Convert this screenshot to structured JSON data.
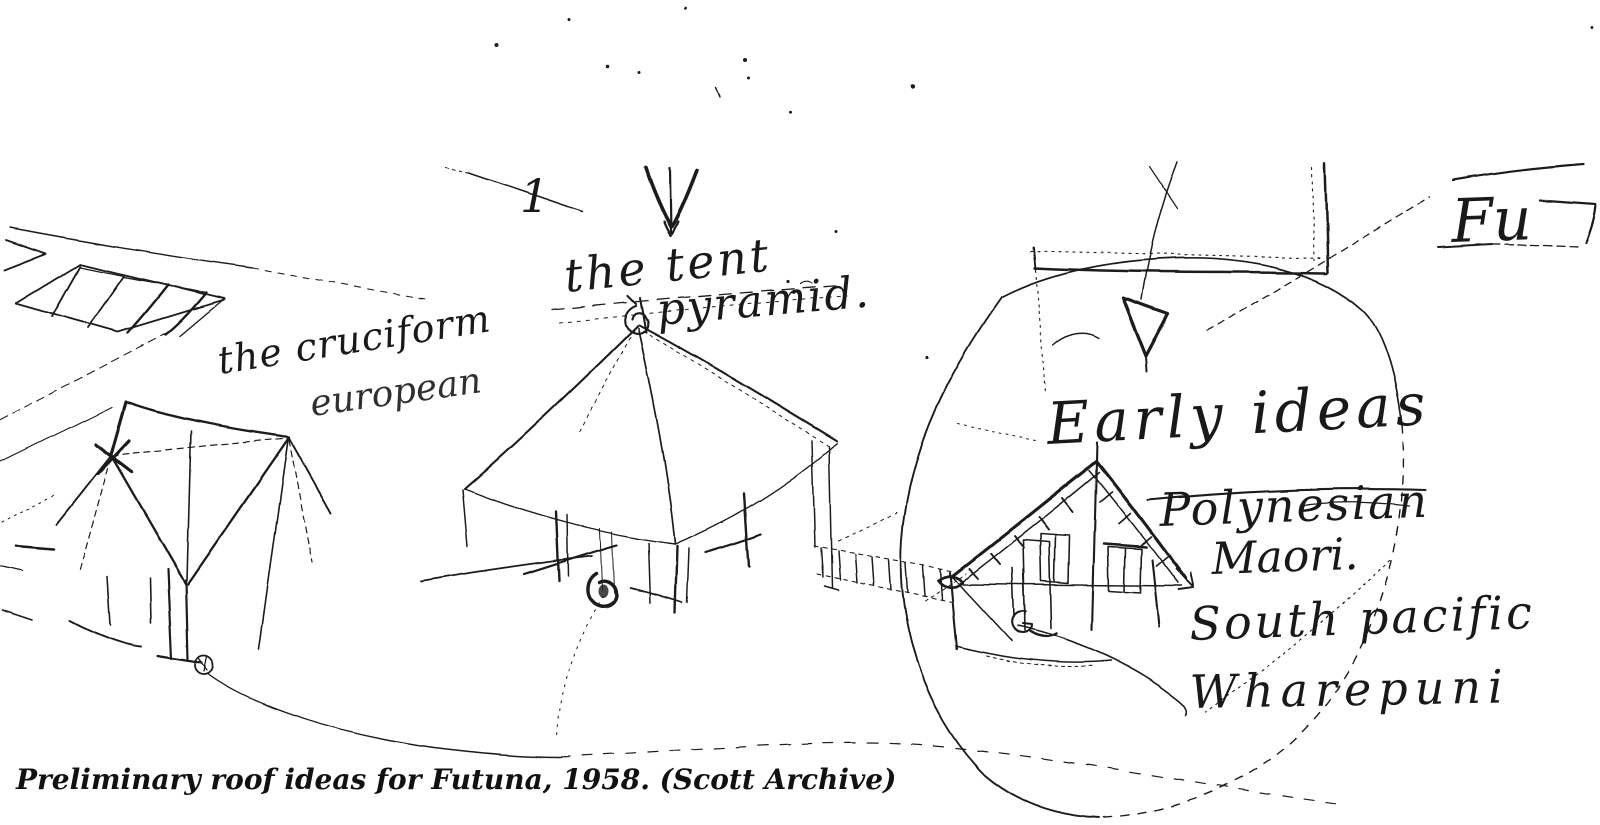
{
  "page": {
    "paper_color": "#ffffff",
    "ink_color": "#1d1d1d",
    "caption": "Preliminary roof ideas for Futuna, 1958. (Scott Archive)"
  },
  "annotations": {
    "marker": "1",
    "tent_line1": "the tent",
    "tent_line2": "pyramid.",
    "cruciform_line1": "the cruciform",
    "cruciform_line2": "european",
    "early_ideas": "Early ideas",
    "polynesian": "Polynesian",
    "maori": "Maori.",
    "south_pacific": "South pacific",
    "wharepuni": "Wharepuni",
    "futuna_partial": "Fu"
  }
}
